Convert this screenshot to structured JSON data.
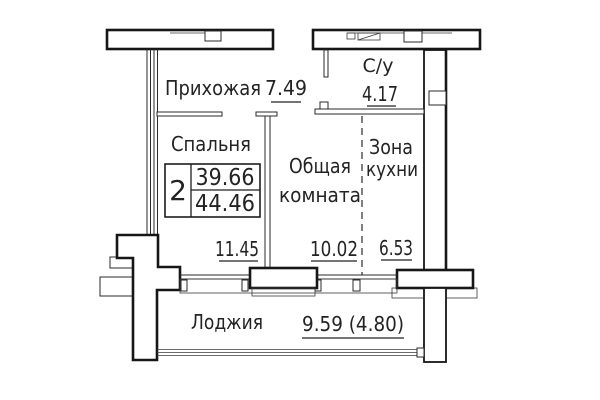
{
  "plan": {
    "stamp": {
      "rooms_count": "2",
      "living_area": "39.66",
      "total_area": "44.46"
    },
    "rooms": {
      "hallway": {
        "name": "Прихожая",
        "area": "7.49"
      },
      "bathroom": {
        "name": "С/у",
        "area": "4.17"
      },
      "bedroom": {
        "name": "Спальня",
        "area": "11.45"
      },
      "living_room": {
        "name_line1": "Общая",
        "name_line2": "комната",
        "area": "10.02"
      },
      "kitchen_zone": {
        "name_line1": "Зона",
        "name_line2": "кухни",
        "area": "6.53"
      },
      "loggia": {
        "name": "Лоджия",
        "area": "9.59 (4.80)"
      }
    }
  }
}
